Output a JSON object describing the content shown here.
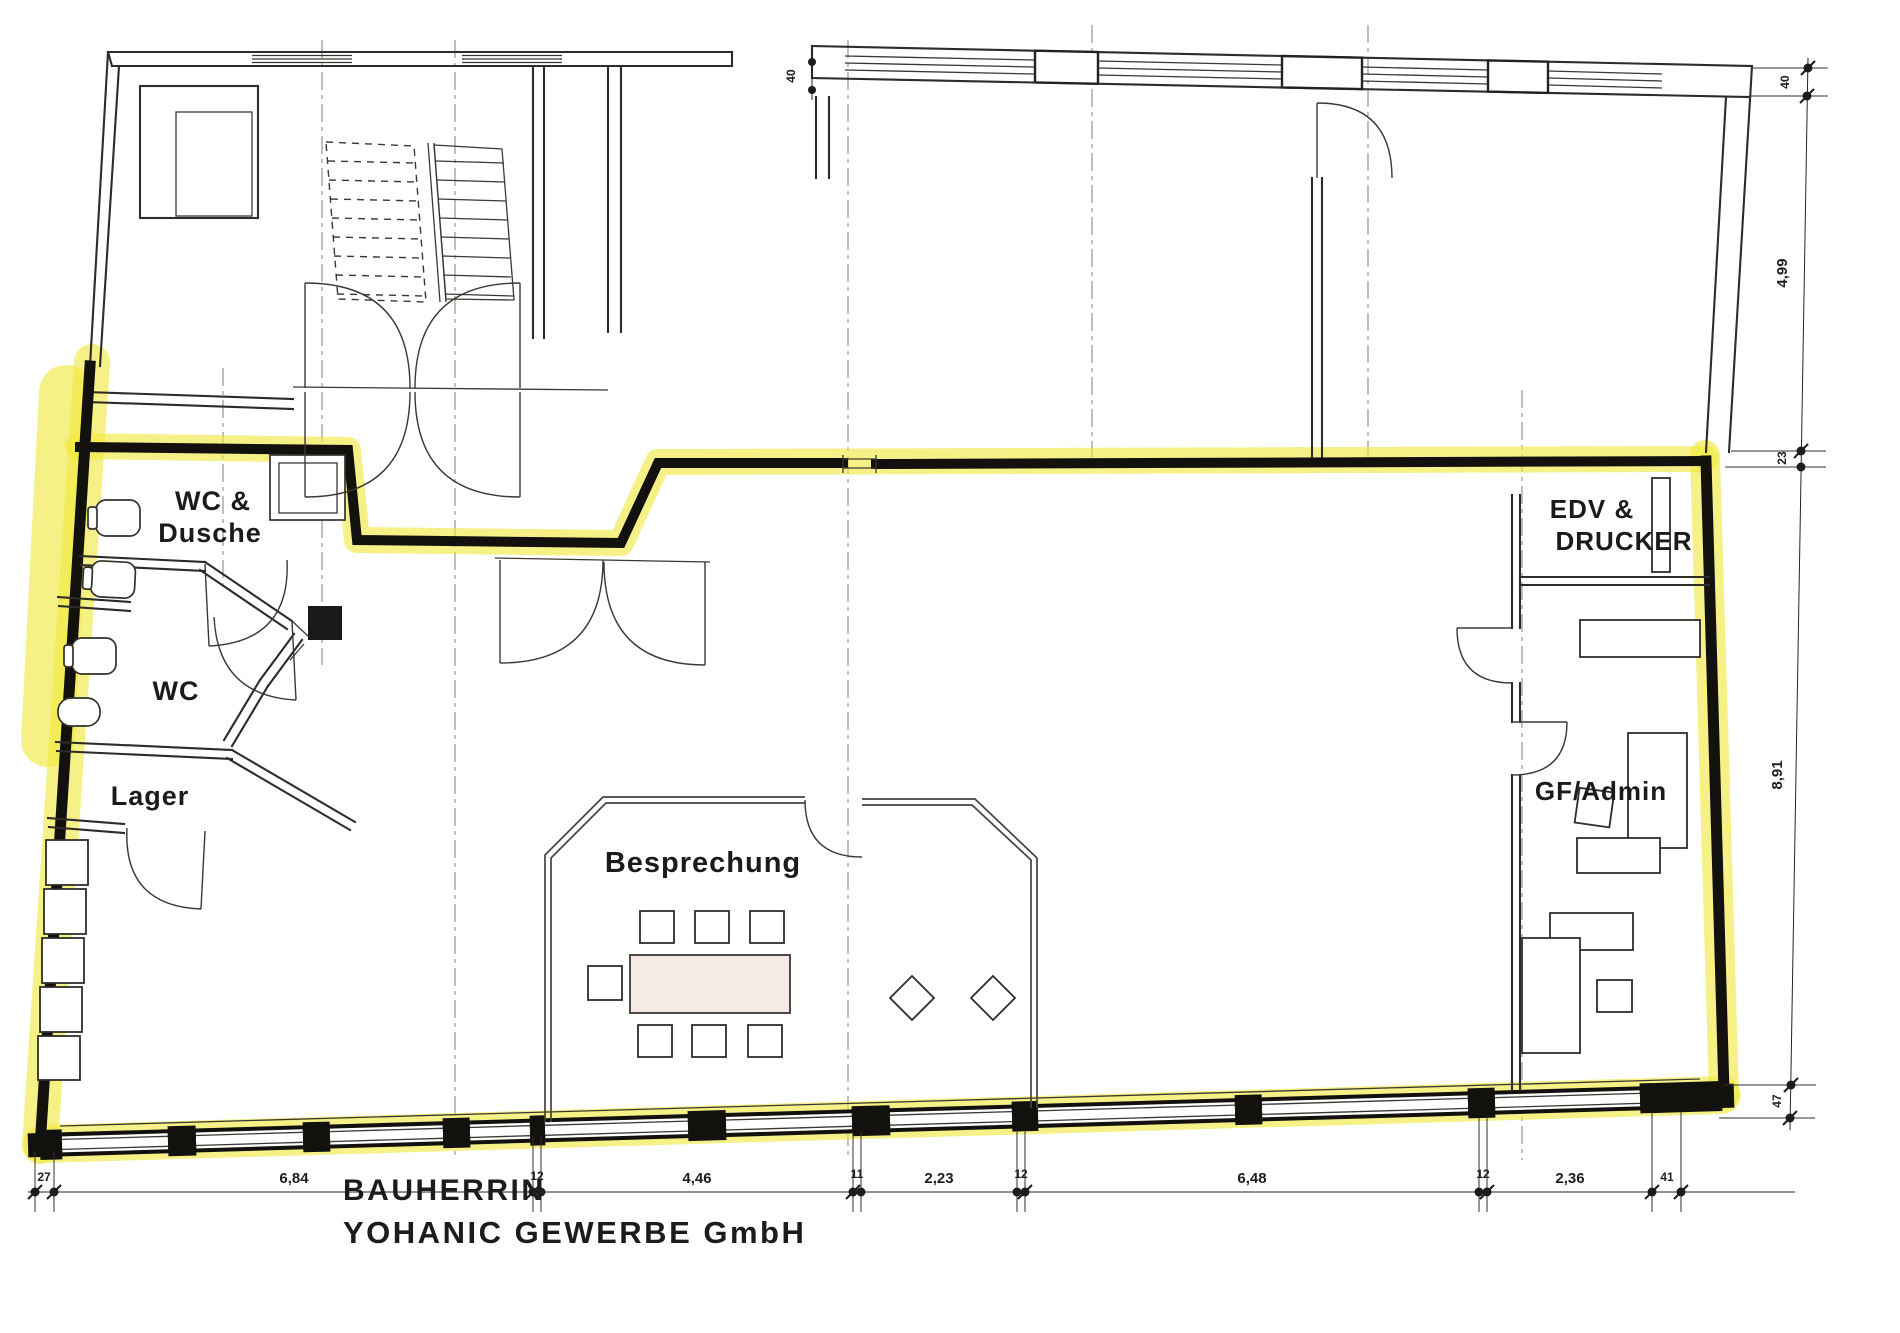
{
  "document": {
    "type": "scanned architectural floor plan with highlighted rental unit"
  },
  "title": {
    "line1": "BAUHERRIN",
    "line2": "YOHANIC GEWERBE GmbH"
  },
  "rooms": {
    "wc_dusche": {
      "line1": "WC &",
      "line2": "Dusche"
    },
    "wc": {
      "label": "WC"
    },
    "lager": {
      "label": "Lager"
    },
    "besprechung": {
      "label": "Besprechung"
    },
    "edv": {
      "line1": "EDV &",
      "line2": "DRUCKER"
    },
    "gf_admin": {
      "label": "GF/Admin"
    }
  },
  "dimensions": {
    "bottom": [
      {
        "label": "27"
      },
      {
        "label": "6,84"
      },
      {
        "label": "12"
      },
      {
        "label": "4,46"
      },
      {
        "label": "11"
      },
      {
        "label": "2,23"
      },
      {
        "label": "12"
      },
      {
        "label": "6,48"
      },
      {
        "label": "12"
      },
      {
        "label": "2,36"
      },
      {
        "label": "41"
      }
    ],
    "right": [
      {
        "label": "40"
      },
      {
        "label": "4,99"
      },
      {
        "label": "23"
      },
      {
        "label": "8,91"
      },
      {
        "label": "47"
      }
    ],
    "top": [
      {
        "label": "40"
      }
    ]
  },
  "colors": {
    "highlight": "#f1e93d",
    "wall": "#12110e",
    "line": "#2e2c28",
    "paper": "#ffffff"
  }
}
